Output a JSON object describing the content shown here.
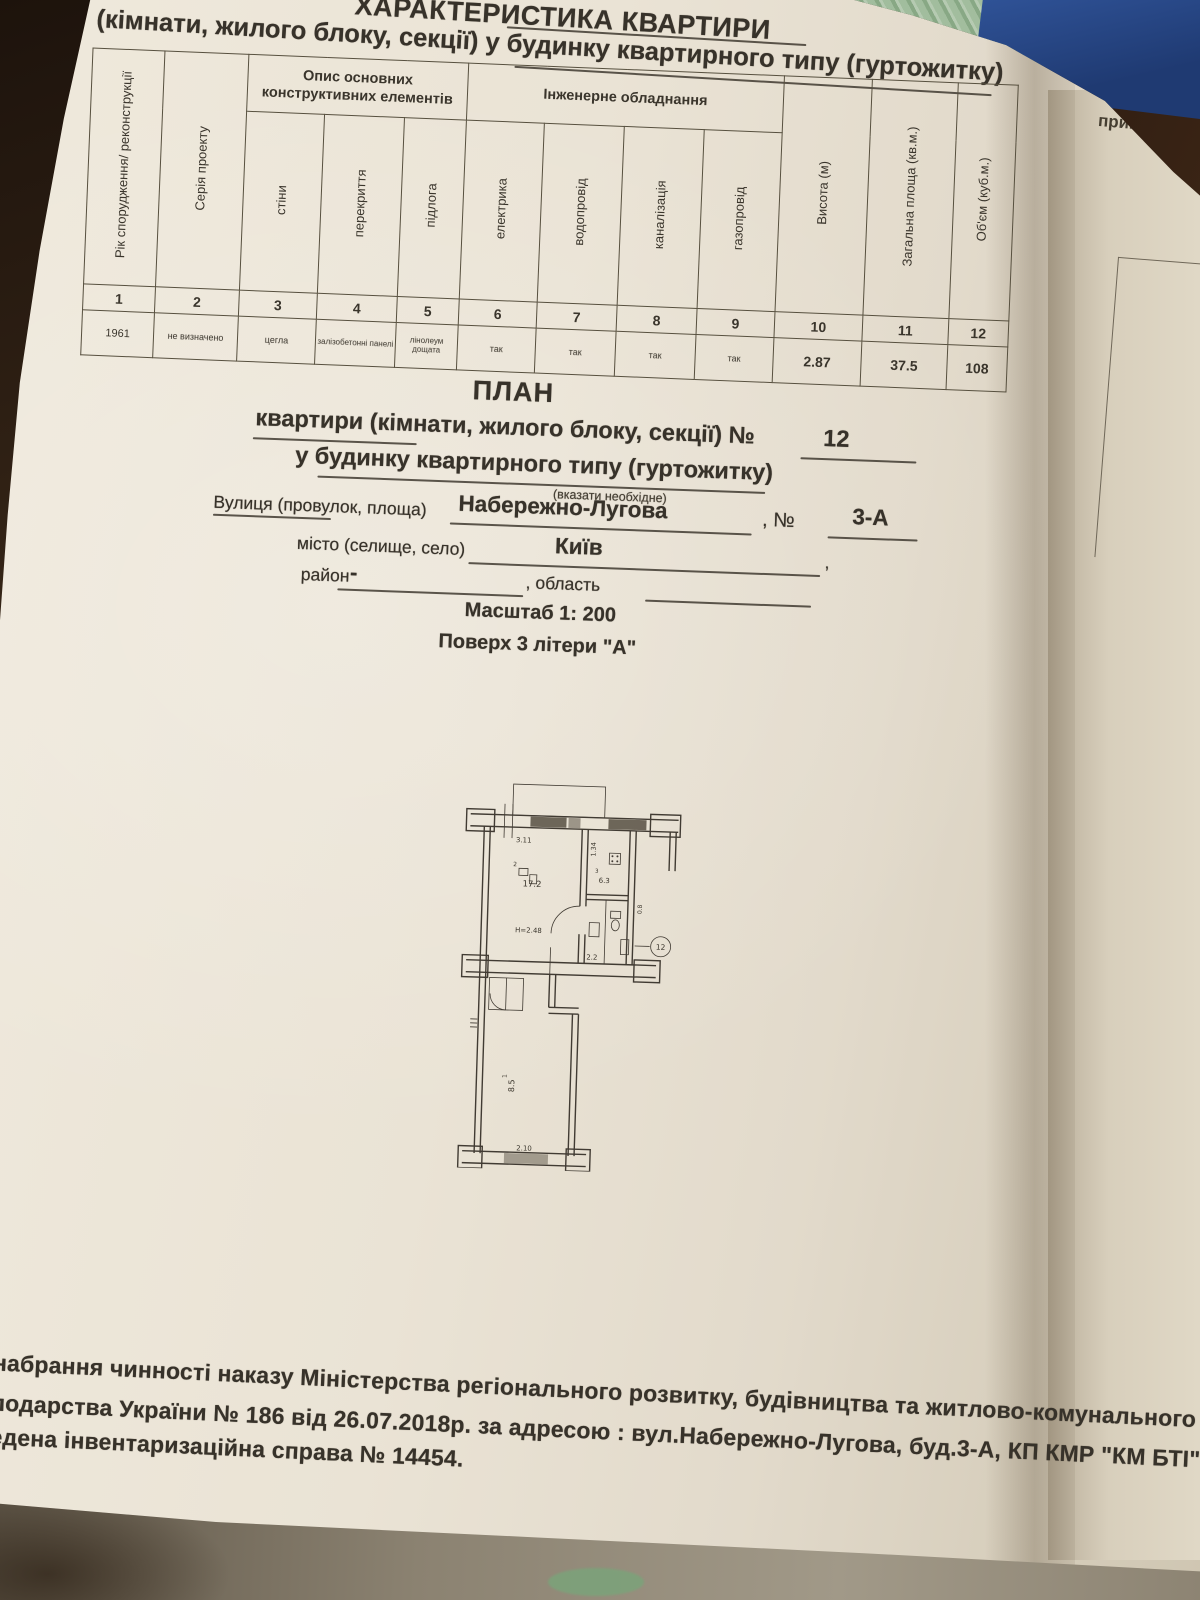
{
  "title": {
    "line1": "ХАРАКТЕРИСТИКА КВАРТИРИ",
    "line2": "(кімнати, жилого блоку, секції) у будинку квартирного типу (гуртожитку)"
  },
  "table": {
    "col1": "Рік спорудження/ реконструкції",
    "col2": "Серія проекту",
    "group1": "Опис основних конструктивних елементів",
    "group2": "Інженерне обладнання",
    "col3": "стіни",
    "col4": "перекриття",
    "col5": "підлога",
    "col6": "електрика",
    "col7": "водопровід",
    "col8": "каналізація",
    "col9": "газопровід",
    "col10": "Висота (м)",
    "col11": "Загальна площа (кв.м.)",
    "col12": "Об'єм (куб.м.)",
    "numbers": [
      "1",
      "2",
      "3",
      "4",
      "5",
      "6",
      "7",
      "8",
      "9",
      "10",
      "11",
      "12"
    ],
    "values": [
      "1961",
      "не визначено",
      "цегла",
      "залізобетонні панелі",
      "лінолеум дощата",
      "так",
      "так",
      "так",
      "так",
      "2.87",
      "37.5",
      "108"
    ]
  },
  "plan_heading": {
    "title": "ПЛАН",
    "line1_text": "квартири (кімнати, жилого блоку, секції) №",
    "line1_value": "12",
    "line2": "у будинку квартирного типу (гуртожитку)",
    "line2_note": "(вказати необхідне)"
  },
  "address": {
    "street_label": "Вулиця (провулок, площа)",
    "street_value": "Набережно-Лугова",
    "no_label": ", №",
    "no_value": "3-А",
    "city_label": "місто (селище, село)",
    "city_value": "Київ",
    "city_tail": ",",
    "district_label": "район",
    "district_value": "-",
    "region_label": ", область",
    "scale": "Масштаб 1: 200",
    "floor_line": "Поверх 3 літери \"А\""
  },
  "floorplan": {
    "dim_top": "3.11",
    "dim_kitchen": "1.34",
    "room_main_no": "2",
    "room_main_area": "17.2",
    "room_height": "Н=2.48",
    "room_kitchen_no": "3",
    "room_kitchen_area": "6.3",
    "room_bath_area": "2.2",
    "dim_small": "0.8",
    "apt_number": "12",
    "room_corridor_no": "1",
    "room_corridor_area": "8.5",
    "dim_bottom": "2.10"
  },
  "footer": {
    "line1": "набрання чинності наказу Міністерства регіонального розвитку, будівництва та житлово-комунального",
    "line2": "подарства України № 186 від 26.07.2018р. за адресою : вул.Набережно-Лугова, буд.3-А, КП КМР \"КМ БТІ\" була",
    "line3": "едена інвентаризаційна справа № 14454."
  },
  "right_page": {
    "top_fragment": "приміще",
    "side_fragment": "пло"
  }
}
